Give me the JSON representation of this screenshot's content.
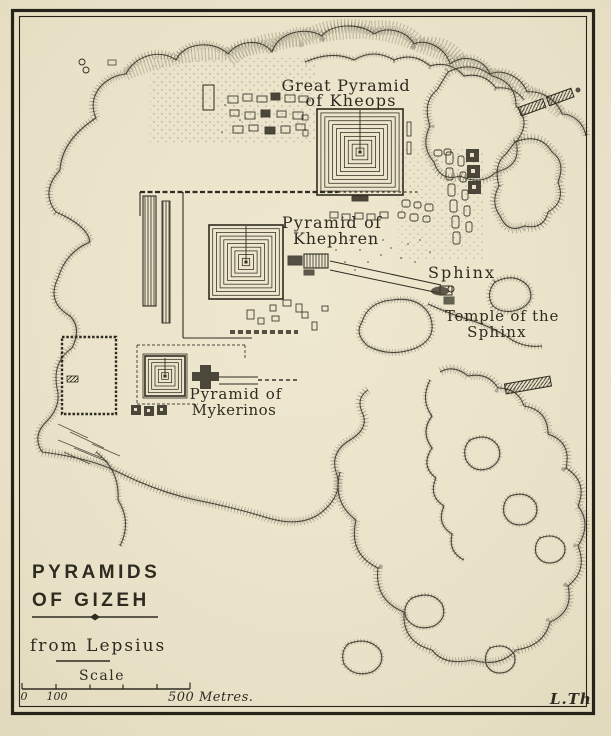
{
  "map": {
    "title_block": {
      "line1": "PYRAMIDS",
      "line2": "OF GIZEH",
      "source": "from Lepsius",
      "scale_heading": "Scale"
    },
    "scale_bar": {
      "start_label": "0",
      "mid_label": "100",
      "end_label": "500 Metres.",
      "total_metres": 500
    },
    "signature": "L.Th",
    "labels": [
      {
        "id": "kheops",
        "lines": [
          "Great Pyramid",
          "of Kheops"
        ]
      },
      {
        "id": "khephren",
        "lines": [
          "Pyramid of",
          "Khephren"
        ]
      },
      {
        "id": "sphinx",
        "lines": [
          "Sphinx"
        ]
      },
      {
        "id": "temple-sphinx",
        "lines": [
          "Temple of the",
          "Sphinx"
        ]
      },
      {
        "id": "mykerinos",
        "lines": [
          "Pyramid of",
          "Mykerinos"
        ]
      }
    ],
    "features": {
      "pyramids": [
        {
          "name": "great-pyramid-of-kheops",
          "cx": 360,
          "cy": 152,
          "size": 86,
          "rings": 11,
          "entrance_from_y": 110
        },
        {
          "name": "pyramid-of-khephren",
          "cx": 246,
          "cy": 262,
          "size": 74,
          "rings": 10,
          "entrance_from_y": 226
        },
        {
          "name": "pyramid-of-mykerinos",
          "cx": 165,
          "cy": 376,
          "size": 40,
          "rings": 6,
          "entrance_from_y": 358
        }
      ]
    },
    "colors": {
      "paper": "#eae3c9",
      "ink": "#2e2b21",
      "hachure": "#8f8977"
    }
  }
}
